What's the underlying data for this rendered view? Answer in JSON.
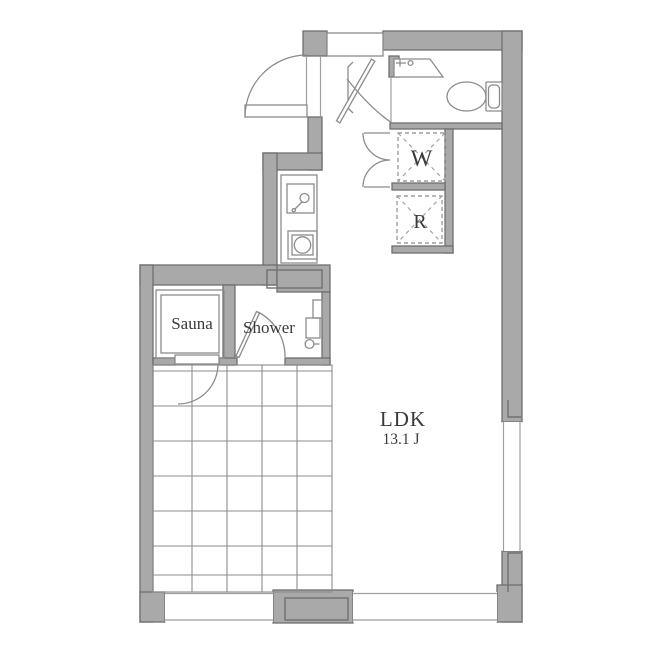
{
  "floorplan": {
    "rooms": {
      "ldk": {
        "label": "LDK",
        "size": "13.1 J"
      },
      "sauna": {
        "label": "Sauna"
      },
      "shower": {
        "label": "Shower"
      },
      "washer": {
        "label": "W"
      },
      "fridge": {
        "label": "R"
      }
    },
    "colors": {
      "bg": "#ffffff",
      "wall_fill": "#a9a9a9",
      "wall_edge": "#6f6f6f",
      "line": "#8c8c8c",
      "line_light": "#9e9e9e",
      "detail": "#707070",
      "text": "#3a3a3a"
    }
  }
}
